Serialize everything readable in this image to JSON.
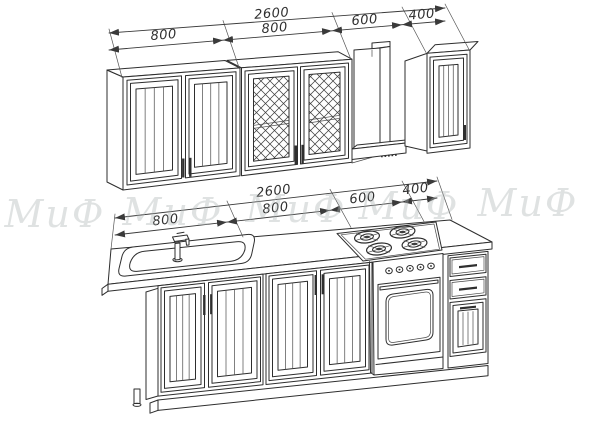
{
  "watermark": {
    "text": "МиФ"
  },
  "dimensions": {
    "upper": {
      "total": "2600",
      "segments": [
        "800",
        "800",
        "600",
        "400"
      ]
    },
    "lower": {
      "total": "2600",
      "segments": [
        "800",
        "800",
        "600",
        "400"
      ]
    }
  },
  "colors": {
    "line": "#2e2e2e",
    "dimension": "#3a3a3a",
    "watermark": "#aeb4b4",
    "background": "#ffffff"
  }
}
